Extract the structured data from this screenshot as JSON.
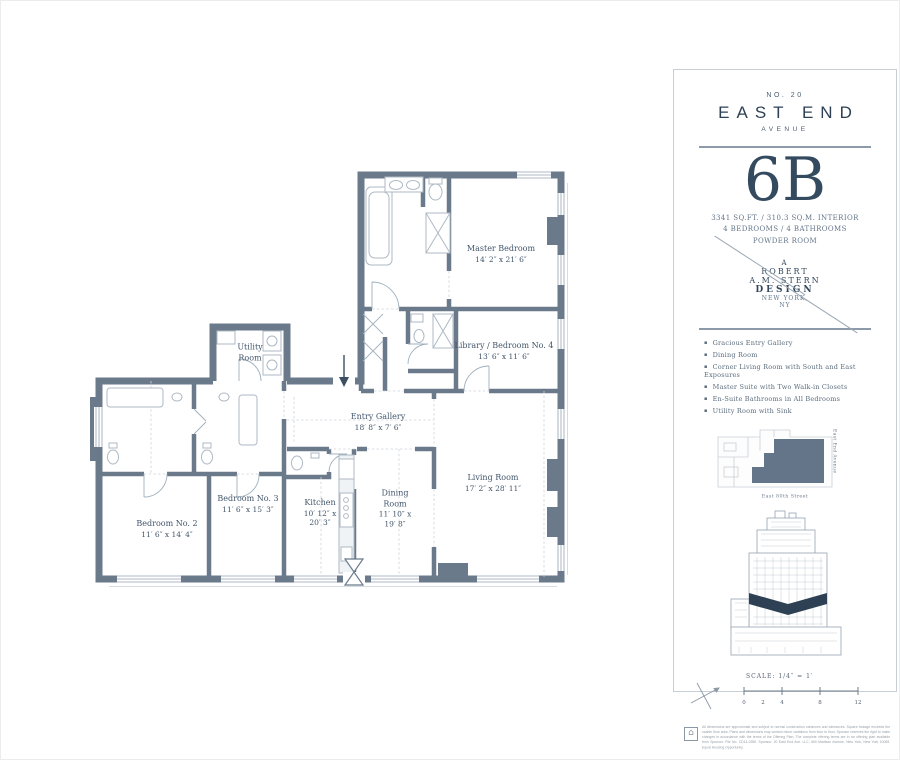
{
  "plan": {
    "wall_color": "#6b7a8b",
    "rooms": [
      {
        "name": "Master Bedroom",
        "dims": "14′ 2″ x 21′ 6″"
      },
      {
        "name": "Library / Bedroom No. 4",
        "dims": "13′ 6″ x 11′ 6″"
      },
      {
        "name": "Utility Room",
        "dims": ""
      },
      {
        "name": "Entry Gallery",
        "dims": "18′ 8″ x 7′ 6″"
      },
      {
        "name": "Bedroom No. 2",
        "dims": "11′ 6″ x 14′ 4″"
      },
      {
        "name": "Bedroom No. 3",
        "dims": "11′ 6″ x 15′ 3″"
      },
      {
        "name": "Kitchen",
        "dims": "10′ 12″ x 20′ 3″"
      },
      {
        "name": "Dining Room",
        "dims": "11′ 10″ x 19′ 8″"
      },
      {
        "name": "Living Room",
        "dims": "17′ 2″ x 28′ 11″"
      }
    ]
  },
  "panel": {
    "building_no": "NO. 20",
    "building_name": "EAST END",
    "building_sub": "AVENUE",
    "unit": "6B",
    "area_line": "3341 SQ.FT.  /  310.3 SQ.M. INTERIOR",
    "rooms_line": "4 BEDROOMS / 4 BATHROOMS",
    "powder_line": "POWDER ROOM",
    "designer": {
      "a": "A",
      "l1": "ROBERT",
      "l2": "A.M. STERN",
      "l3": "DESIGN",
      "l4": "NEW YORK,",
      "l5": "NY"
    },
    "features": [
      "Gracious Entry Gallery",
      "Dining Room",
      "Corner Living Room with South and East Exposures",
      "Master Suite with Two Walk-in Closets",
      "En-Suite Bathrooms in All Bedrooms",
      "Utility Room with Sink"
    ],
    "keyplan": {
      "street_right": "East End Avenue",
      "street_bottom": "East 80th Street"
    },
    "scale": {
      "label": "SCALE: 1/4″ = 1′",
      "ticks": [
        "0",
        "2",
        "4",
        "8",
        "12"
      ]
    },
    "disclaimer": "All dimensions are approximate and subject to normal construction variances and tolerances. Square footage exceeds the usable floor area. Plans and dimensions may contain minor variations from floor to floor. Sponsor reserves the right to make changes in accordance with the terms of the Offering Plan. The complete offering terms are in an offering plan available from Sponsor. File No. CD14-0280. Sponsor: 20 East End Ave. LLC, 660 Madison Avenue, New York, New York 10065. Equal Housing Opportunity."
  }
}
